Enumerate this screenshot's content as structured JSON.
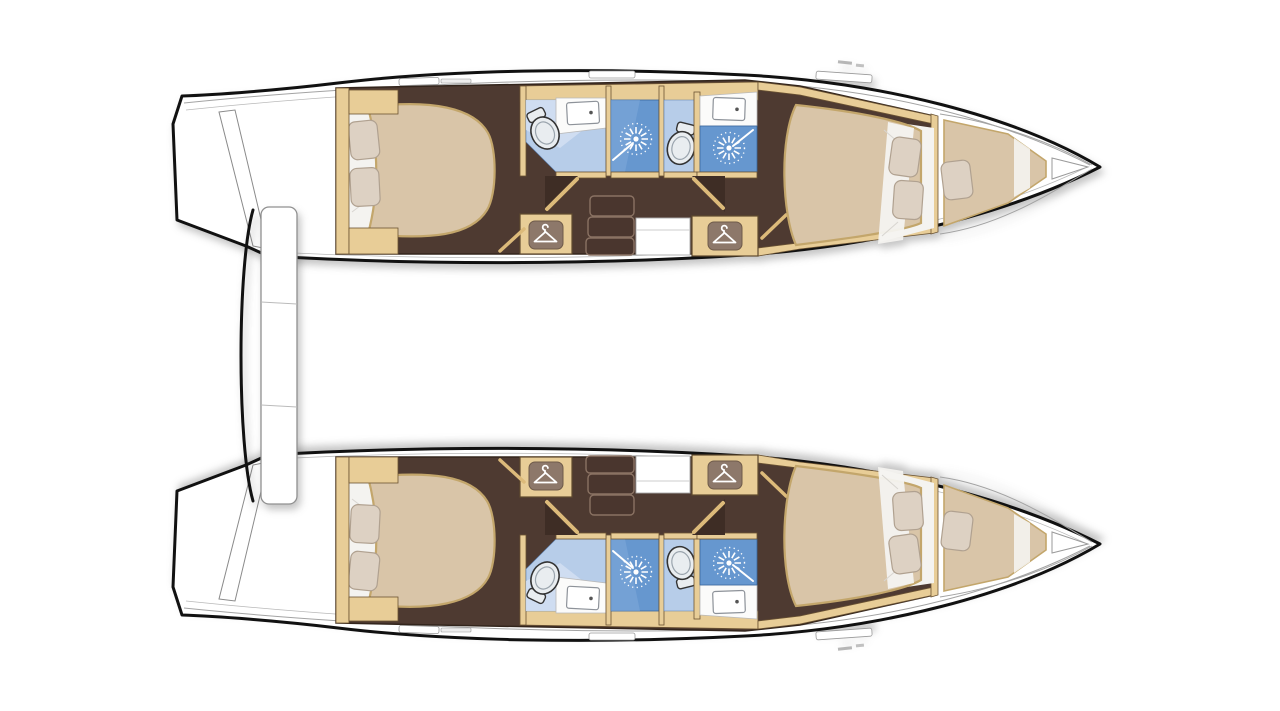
{
  "diagram": {
    "kind": "catamaran-interior-floorplan",
    "hulls": [
      "top-hull",
      "bottom-hull"
    ],
    "rooms_per_hull": [
      "aft-cabin",
      "aft-head",
      "aft-shower",
      "wardrobe",
      "companionway-steps",
      "forward-head",
      "forward-shower",
      "forward-cabin",
      "forepeak-berth"
    ],
    "beds_per_hull": 3,
    "pillows_per_hull": 5
  },
  "colors": {
    "background": "#ffffff",
    "hull_outline": "#111111",
    "deck": "#ffffff",
    "deck_line": "#a3a3a3",
    "cabinetry_tan": "#e8cd97",
    "door_tan": "#dcba7a",
    "floor_brown": "#4e3a31",
    "floor_shadow": "#3e2d25",
    "bed": "#d9c5a8",
    "bed_edge": "#c3a66b",
    "bedding_white": "#f4f3f0",
    "pillow": "#ddd1c3",
    "pillow_edge": "#b0a190",
    "bath_floor": "#b7cde9",
    "bath_floor_light": "#d3dff2",
    "shower_blue": "#6697cf",
    "shower_blue_light": "#7fa9da",
    "fixture_white": "#e9edf0",
    "icon_plate": "#8d786a",
    "icon_glyph": "#ffffff",
    "step_edge": "#8a7263",
    "platform_edge": "#909090"
  },
  "icons": {
    "hanger": "clothes-hanger-icon",
    "shower": "shower-spray-icon",
    "toilet": "toilet-icon",
    "sink": "sink-icon"
  }
}
